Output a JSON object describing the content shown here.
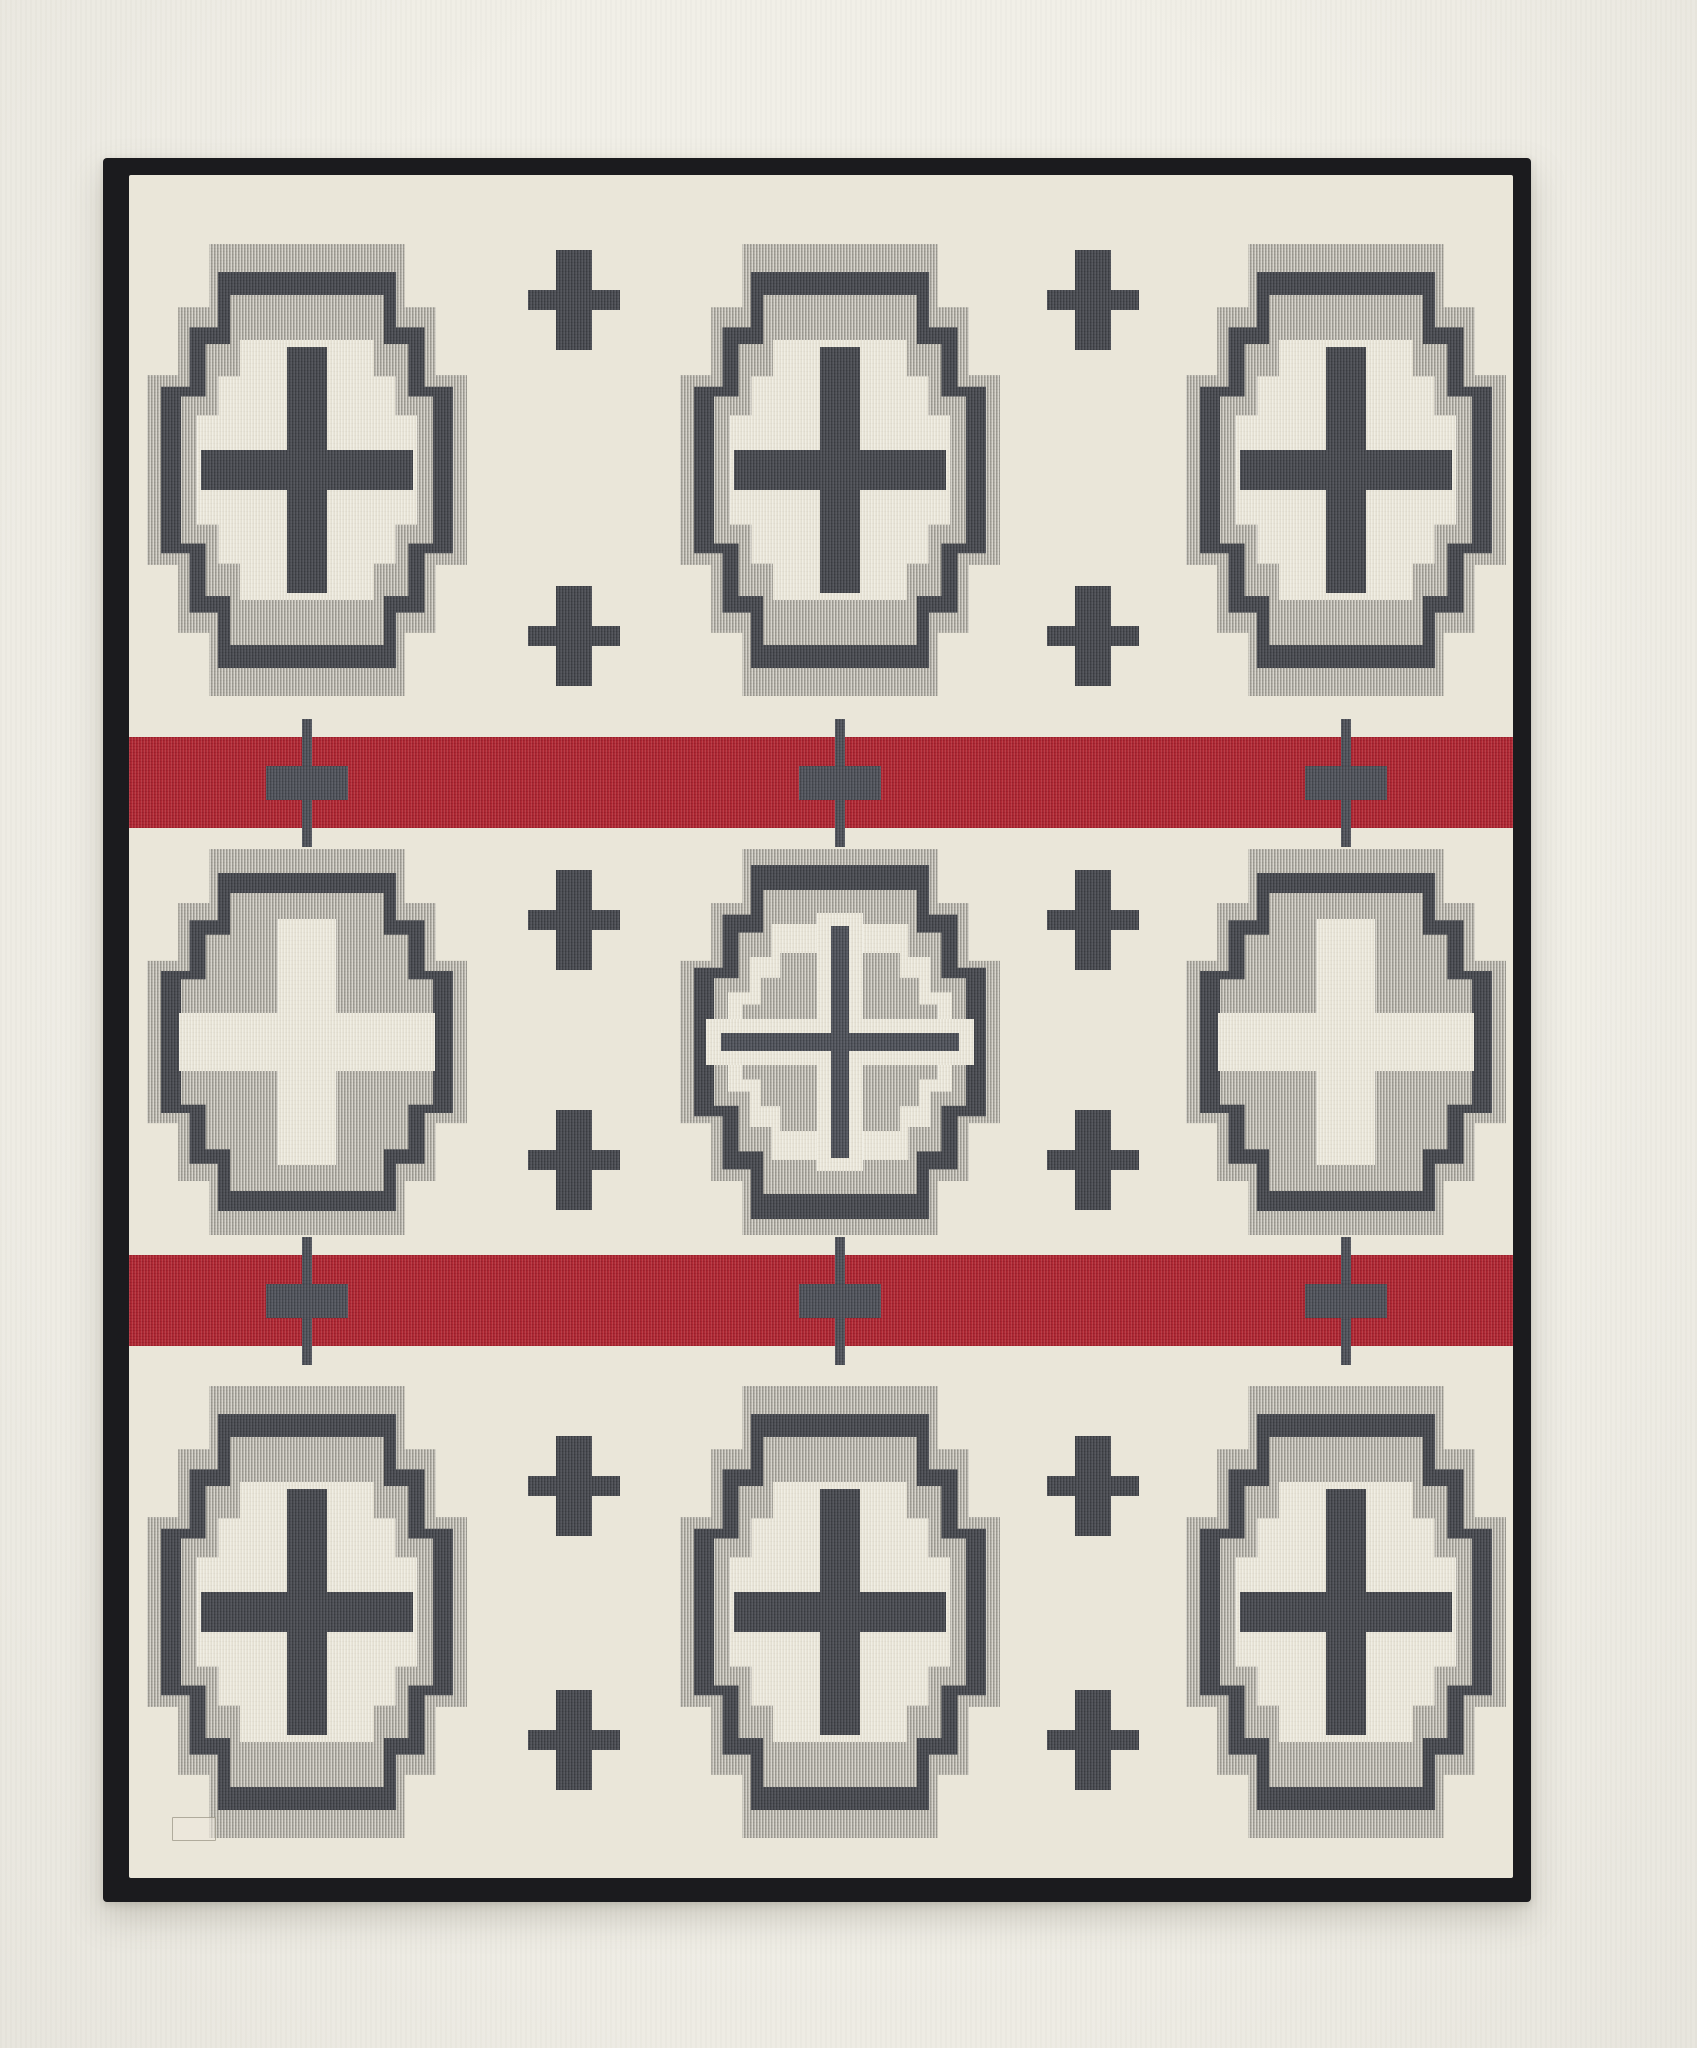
{
  "subject": "wool-blanket-product-photo",
  "palette": {
    "photo_background": "#f1efe7",
    "cream": "#eae6d9",
    "heather": "#b0ada4",
    "dark": "#45474e",
    "dark_soft": "#4d5058",
    "red": "#b02330",
    "binding": "#1b1b1e"
  },
  "blanket": {
    "x": 103,
    "y": 158,
    "width": 1428,
    "height": 1744,
    "binding_width": {
      "top": 17,
      "right": 18,
      "bottom": 24,
      "left": 26
    }
  },
  "field": {
    "width": 1384,
    "height": 1703
  },
  "cross_shape": {
    "arm_half_frac_x": 0.61,
    "step_half_frac_x": 0.805,
    "arm_half_frac_y": 0.42,
    "step_half_frac_y": 0.72
  },
  "cross_styles": {
    "dark_plus": {
      "size": [
        320,
        452
      ],
      "layers": [
        [
          0,
          0,
          "heather"
        ],
        [
          14,
          28,
          "dark"
        ],
        [
          34,
          51,
          "heather"
        ],
        [
          50,
          96,
          "cream"
        ]
      ],
      "pluses": [
        {
          "v": [
            40,
            246
          ],
          "h": [
            212,
            40
          ],
          "color": "dark"
        }
      ]
    },
    "cream_plus": {
      "size": [
        320,
        386
      ],
      "layers": [
        [
          0,
          0,
          "heather"
        ],
        [
          14,
          24,
          "dark"
        ],
        [
          34,
          44,
          "heather"
        ]
      ],
      "pluses": [
        {
          "v": [
            58,
            246
          ],
          "h": [
            256,
            58
          ],
          "color": "cream"
        }
      ]
    },
    "nested": {
      "size": [
        320,
        386
      ],
      "layers": [
        [
          0,
          0,
          "heather"
        ],
        [
          14,
          16,
          "dark"
        ],
        [
          34,
          41,
          "heather"
        ],
        [
          48,
          75,
          "cream"
        ],
        [
          62,
          104,
          "heather"
        ]
      ],
      "pluses": [
        {
          "v": [
            46,
            258
          ],
          "h": [
            268,
            46
          ],
          "color": "cream"
        },
        {
          "v": [
            18,
            232
          ],
          "h": [
            238,
            18
          ],
          "color": "dark_soft"
        }
      ]
    }
  },
  "crosses": [
    {
      "row": 1,
      "col": 1,
      "cx": 178,
      "cy": 295,
      "style": "dark_plus"
    },
    {
      "row": 1,
      "col": 2,
      "cx": 711,
      "cy": 295,
      "style": "dark_plus"
    },
    {
      "row": 1,
      "col": 3,
      "cx": 1217,
      "cy": 295,
      "style": "dark_plus"
    },
    {
      "row": 2,
      "col": 1,
      "cx": 178,
      "cy": 867,
      "style": "cream_plus"
    },
    {
      "row": 2,
      "col": 2,
      "cx": 711,
      "cy": 867,
      "style": "nested"
    },
    {
      "row": 2,
      "col": 3,
      "cx": 1217,
      "cy": 867,
      "style": "cream_plus"
    },
    {
      "row": 3,
      "col": 1,
      "cx": 178,
      "cy": 1437,
      "style": "dark_plus"
    },
    {
      "row": 3,
      "col": 2,
      "cx": 711,
      "cy": 1437,
      "style": "dark_plus"
    },
    {
      "row": 3,
      "col": 3,
      "cx": 1217,
      "cy": 1437,
      "style": "dark_plus"
    }
  ],
  "small_plus": {
    "v": [
      36,
      100
    ],
    "h": [
      92,
      20
    ],
    "color": "dark",
    "columns": [
      445,
      964
    ],
    "rows_y": [
      125,
      461,
      745,
      985,
      1311,
      1565
    ]
  },
  "stripes": [
    {
      "y": 562,
      "height": 91,
      "cross_x": [
        178,
        711,
        1217
      ]
    },
    {
      "y": 1080,
      "height": 91,
      "cross_x": [
        178,
        711,
        1217
      ]
    }
  ],
  "stripe_cross": {
    "line": [
      10,
      128
    ],
    "bar": [
      82,
      34
    ],
    "color": "dark_soft"
  },
  "label_tag": {
    "x": 43,
    "y": 1642,
    "width": 44,
    "height": 24
  }
}
